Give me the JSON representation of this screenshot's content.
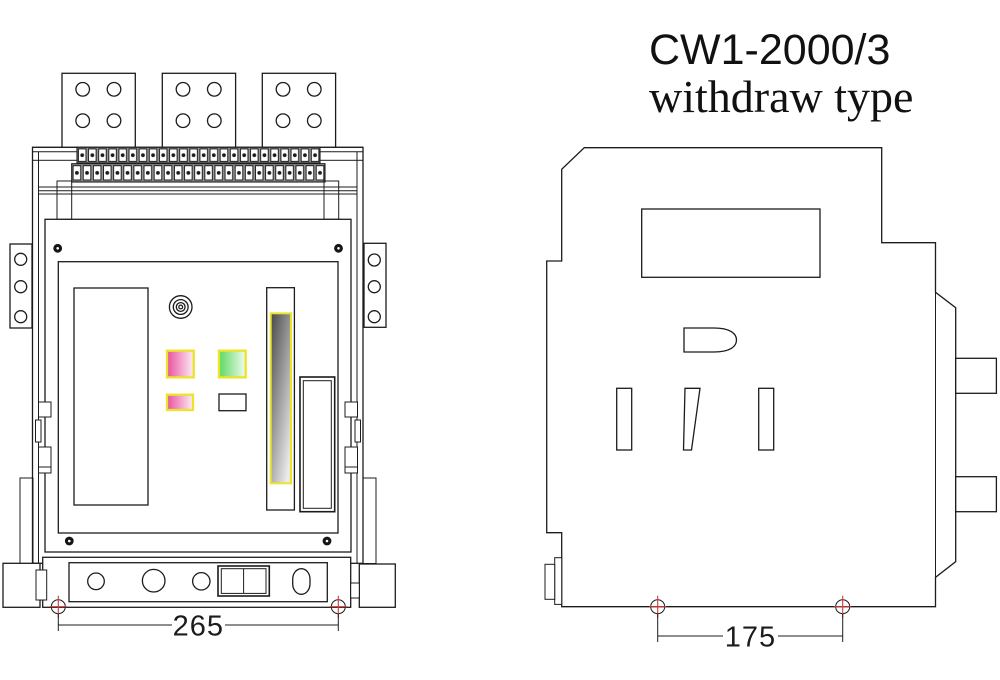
{
  "title": {
    "line1": "CW1-2000/3",
    "line2": "withdraw type"
  },
  "front_view": {
    "label": "front view of drawer-type circuit breaker",
    "dimension": {
      "value": "265"
    },
    "terminal_strip": {
      "top_row_cells": 24,
      "bottom_row_cells": 25
    },
    "busbar_plates": 3,
    "holes_per_plate": 4
  },
  "side_view": {
    "label": "side view of drawer-type circuit breaker",
    "dimension": {
      "value": "175"
    },
    "slots": 3
  },
  "colors": {
    "line": "#1c1c1c",
    "marker_red": "#d23a3a",
    "indicator_border": "#ece32b",
    "pink_start": "#e8509d",
    "pink_end": "#fdeef7",
    "green_start": "#5bd961",
    "green_end": "#f1fbf0",
    "gray_start": "#484848",
    "gray_mid": "#909090",
    "gray_end": "#eaeaea",
    "terminal_gap": "#9a9a9a"
  }
}
